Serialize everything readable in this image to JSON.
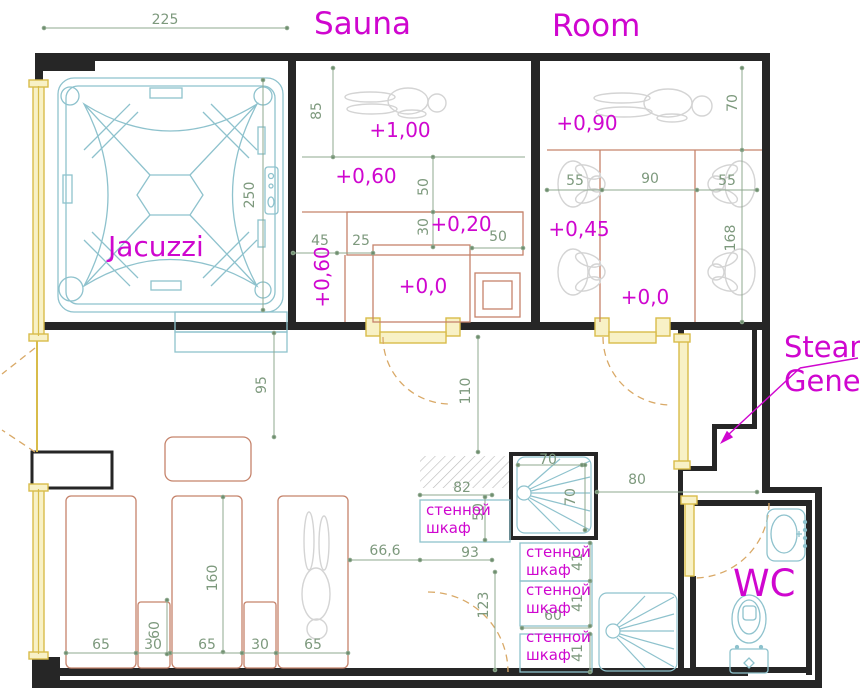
{
  "titles": {
    "jacuzzi": "Jacuzzi",
    "sauna": "Sauna",
    "steam_room_line1": "Steam",
    "steam_room_line2": "Room",
    "wc": "WC"
  },
  "annotation": {
    "line1": "Steam",
    "line2": "Gene"
  },
  "levels": {
    "sauna_top": "+1,00",
    "sauna_mid": "+0,60",
    "sauna_step": "+0,20",
    "sauna_floor": "+0,0",
    "sauna_side": "+0,60",
    "steam_top": "+0,90",
    "steam_mid": "+0,45",
    "steam_floor": "+0,0"
  },
  "dims": {
    "top_width": "225",
    "jacuzzi_side": "250",
    "sauna_d85": "85",
    "sauna_d50v": "50",
    "sauna_d30": "30",
    "sauna_d45": "45",
    "sauna_d25": "25",
    "sauna_d50h": "50",
    "steam_d70": "70",
    "steam_d55l": "55",
    "steam_d90": "90",
    "steam_d55r": "55",
    "steam_d168": "168",
    "step_d95": "95",
    "hall_d110": "110",
    "closet_d82": "82",
    "closet_d50": "50",
    "closet_d93": "93",
    "lounge_d66": "66,6",
    "lounge_d160": "160",
    "lounge_d65a": "65",
    "lounge_d30a": "30",
    "lounge_d65b": "65",
    "lounge_d30b": "30",
    "lounge_d65c": "65",
    "table_d60": "60",
    "pass_d123": "123",
    "wc_d80": "80",
    "shower_d70w": "70",
    "shower_d70h": "70",
    "cell_d41a": "41",
    "cell_d41b": "41",
    "cell_d41c": "41",
    "cell_d60": "60"
  },
  "closet": {
    "line1": "стенной",
    "line2": "шкаф"
  },
  "colors": {
    "magenta": "#cf06cf",
    "dim_green": "#7d997d",
    "fixture_cyan": "#8ec2cd",
    "furniture_salmon": "#c5836b",
    "door_yellow": "#d8bc4a",
    "wall": "#262626",
    "figure_gray": "#d4d4d4"
  }
}
